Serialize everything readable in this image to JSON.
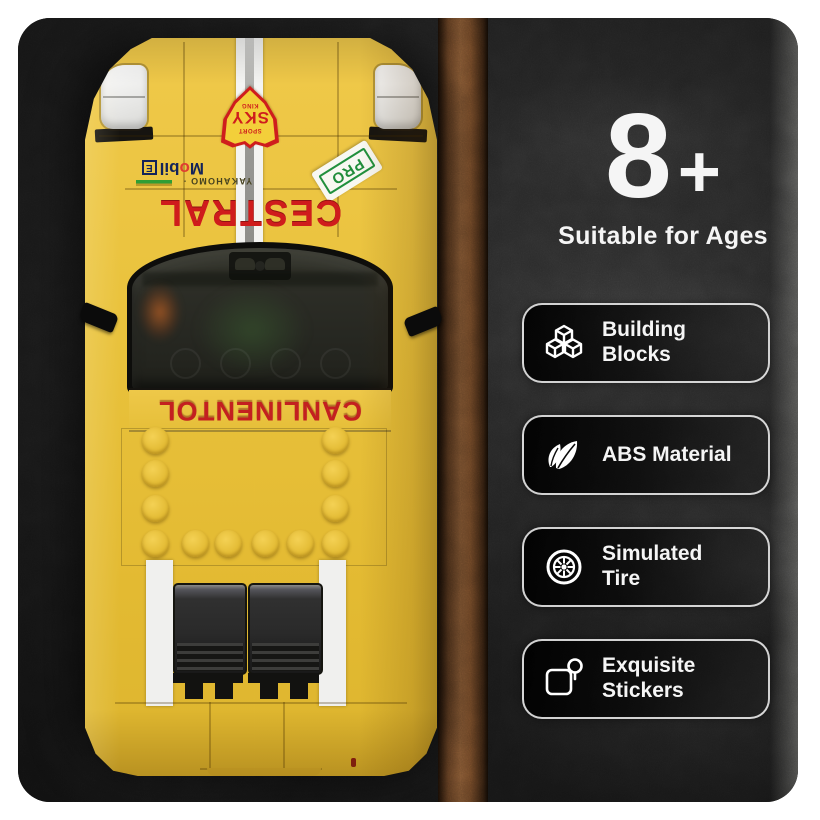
{
  "product_panel": {
    "age": {
      "number": "8",
      "plus": "+",
      "label": "Suitable for Ages"
    },
    "features": [
      {
        "icon": "cubes-icon",
        "line1": "Building",
        "line2": "Blocks"
      },
      {
        "icon": "leaf-icon",
        "line1": "ABS Material",
        "line2": ""
      },
      {
        "icon": "tire-icon",
        "line1": "Simulated",
        "line2": "Tire"
      },
      {
        "icon": "sticker-icon",
        "line1": "Exquisite",
        "line2": "Stickers"
      }
    ]
  },
  "car_model": {
    "hood_badge": {
      "small_top": "SPORT",
      "main": "SKY",
      "small_bottom": "KING"
    },
    "oil_sticker": {
      "pre": "M",
      "o": "o",
      "post": "bil",
      "box": "E"
    },
    "cowl_small_text": "YAKAHOMO ·",
    "cowl_main_text": "CESTRAL",
    "windshield_banner": "CANLINENTOL",
    "pro_sticker": "PRO"
  },
  "colors": {
    "body_yellow": "#e8c13c",
    "sticker_red": "#c62020",
    "pro_green": "#21903d",
    "mobil_navy": "#13235a",
    "ground_brown": "#8a5c36",
    "background_black": "#1b1b1b",
    "text_white": "#f5f5f5"
  }
}
